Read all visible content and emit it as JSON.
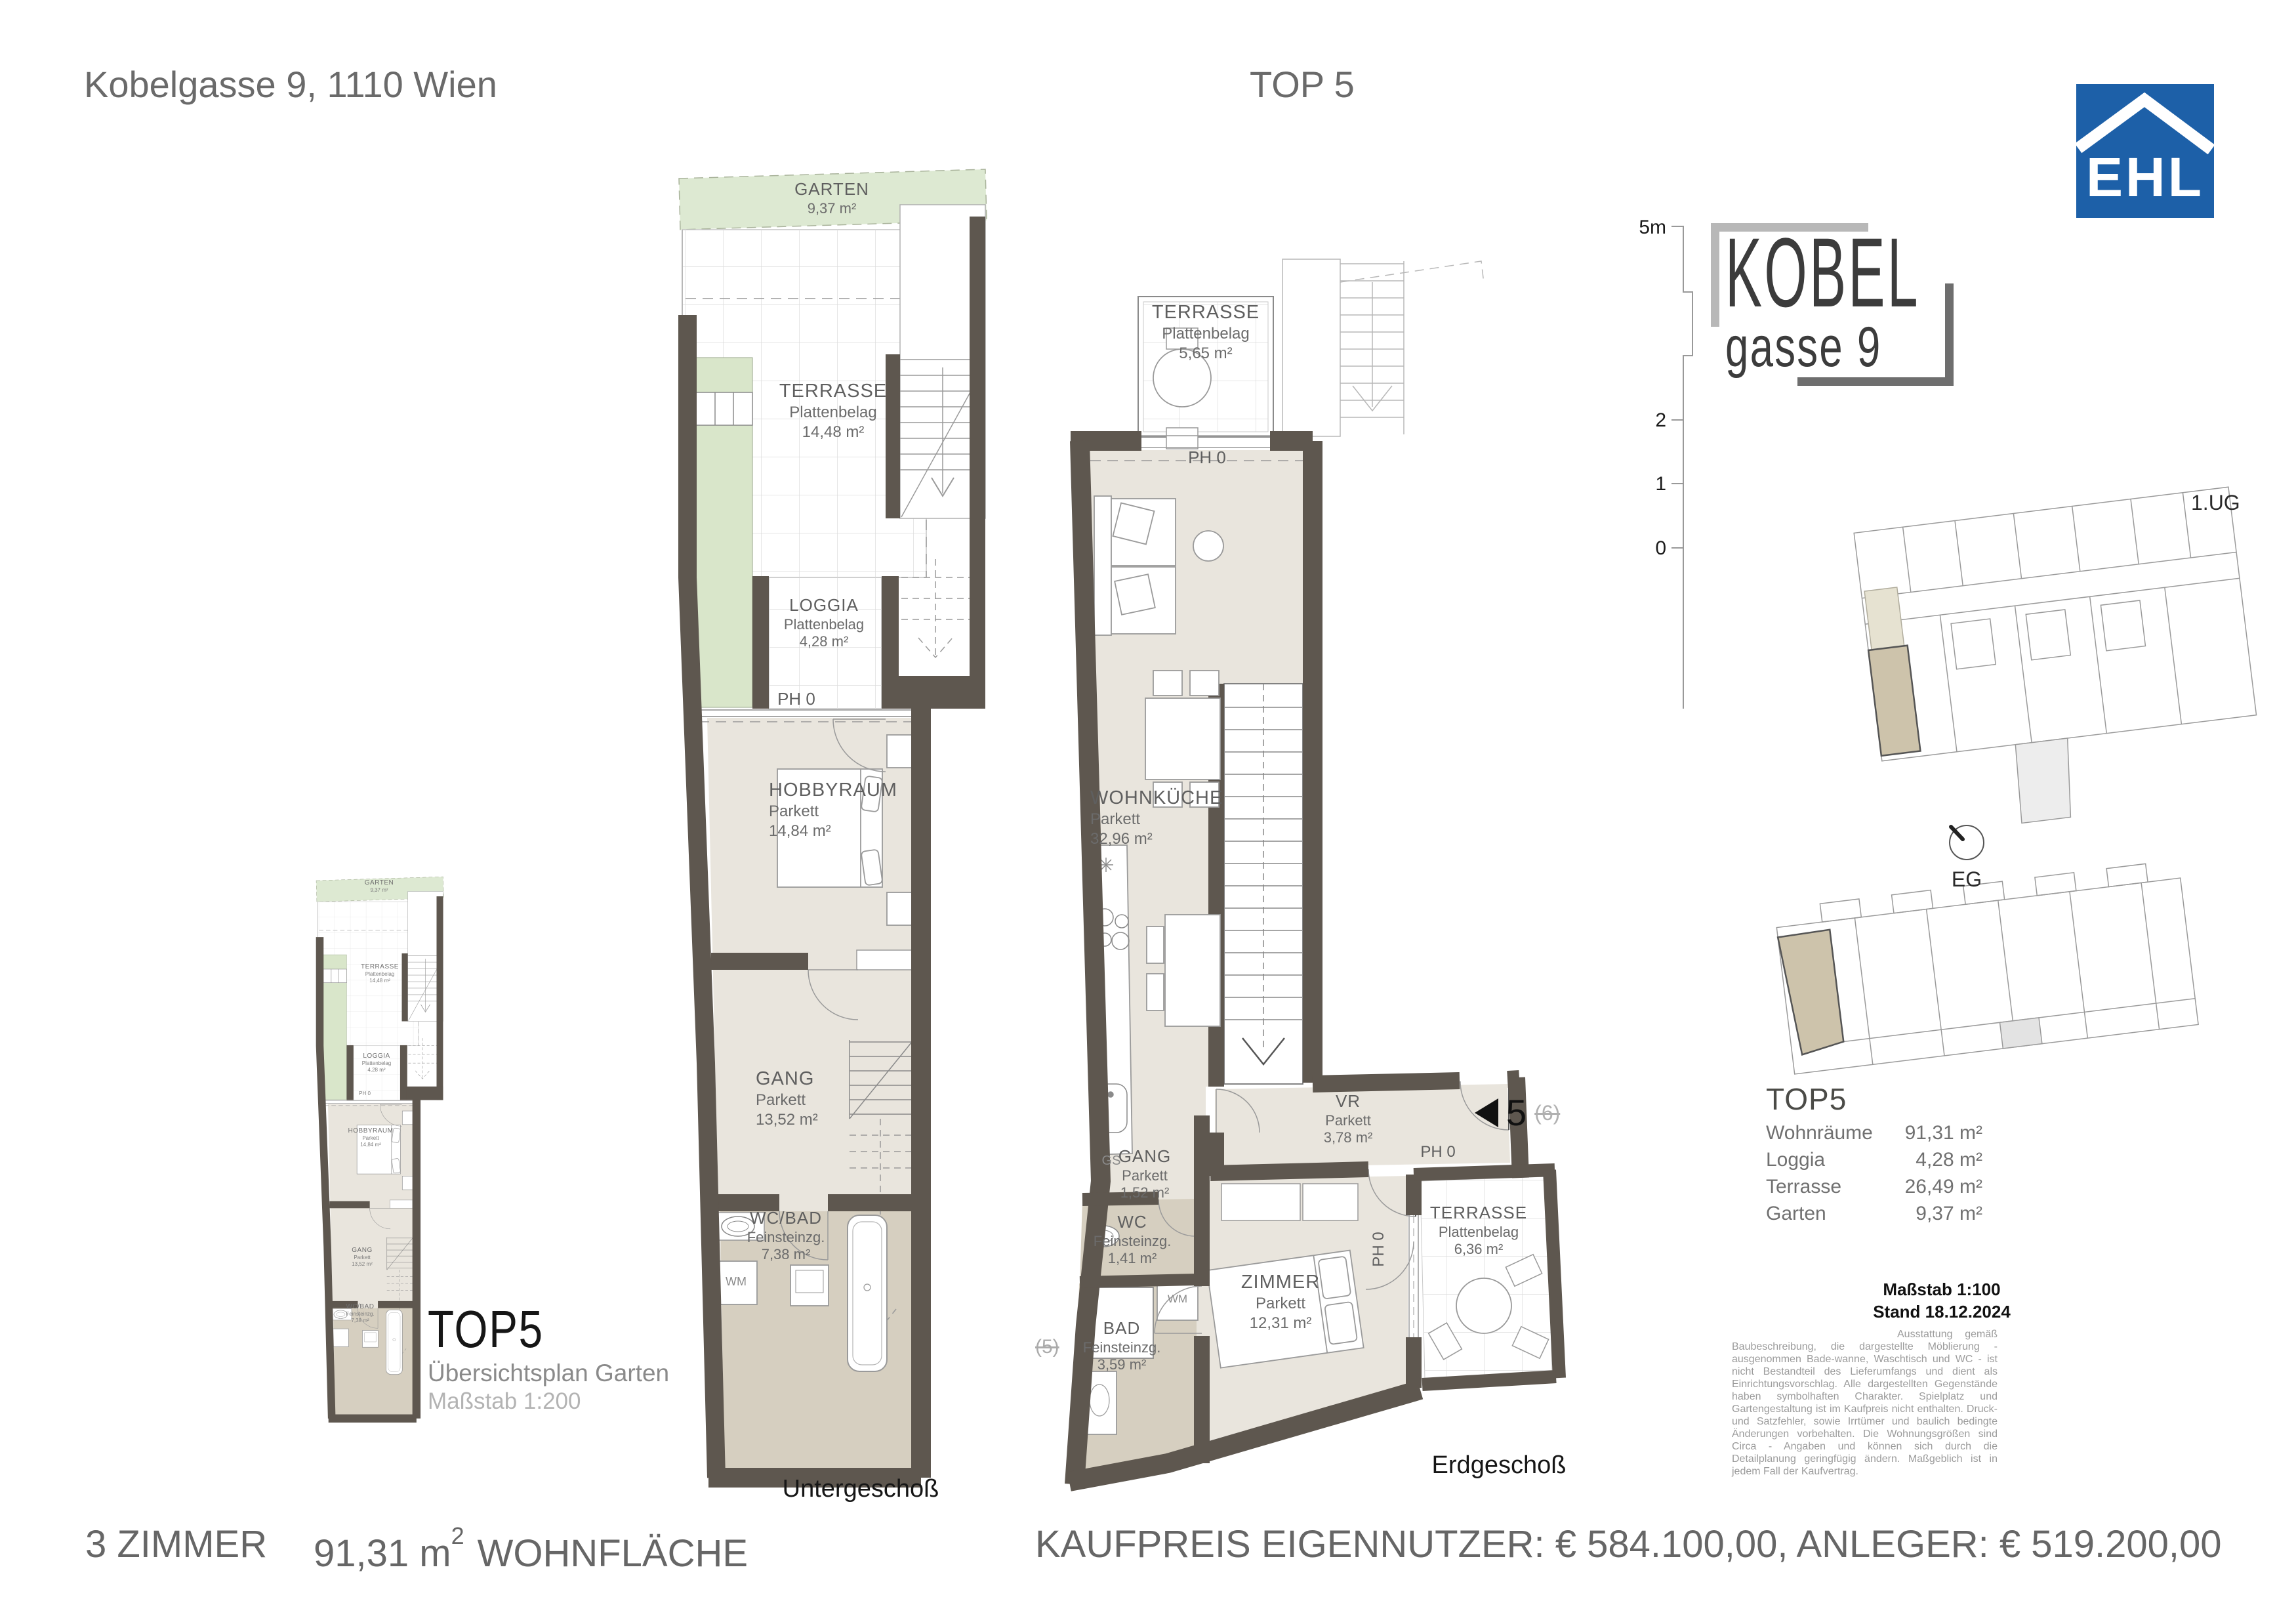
{
  "header": {
    "address": "Kobelgasse 9, 1110 Wien",
    "unit_title": "TOP 5"
  },
  "ehl_logo": {
    "text": "EHL",
    "blue": "#1d60a8"
  },
  "brand": {
    "line1": "KOBEL",
    "line2": "gasse 9"
  },
  "scale_bar": {
    "top": "5m",
    "mid": "2",
    "low": "1",
    "zero": "0"
  },
  "site_plans": {
    "upper": "1.UG",
    "lower": "EG"
  },
  "summary": {
    "title": "TOP5",
    "rows": [
      {
        "label": "Wohnräume",
        "value": "91,31 m²"
      },
      {
        "label": "Loggia",
        "value": "4,28 m²"
      },
      {
        "label": "Terrasse",
        "value": "26,49 m²"
      },
      {
        "label": "Garten",
        "value": "9,37 m²"
      }
    ],
    "scale": "Maßstab 1:100",
    "date": "Stand 18.12.2024",
    "disclaimer": "Ausstattung gemäß Baubeschreibung, die dargestellte Möblierung - ausgenommen Bade-wanne, Waschtisch und WC - ist nicht Bestandteil des Lieferumfangs und dient als Einrichtungsvorschlag. Alle dargestellten Gegenstände haben symbolhaften Charakter. Spielplatz und Gartengestaltung ist im Kaufpreis nicht enthalten. Druck- und Satzfehler, sowie Irrtümer und baulich bedingte Änderungen vorbehalten. Die Wohnungsgrößen sind Circa - Angaben und können sich durch die Detailplanung geringfügig ändern. Maßgeblich ist in jedem Fall der Kaufvertrag."
  },
  "basement": {
    "caption": "Untergeschoß",
    "garten": {
      "name": "GARTEN",
      "area": "9,37 m²"
    },
    "terrasse": {
      "name": "TERRASSE",
      "finish": "Plattenbelag",
      "area": "14,48 m²"
    },
    "loggia": {
      "name": "LOGGIA",
      "finish": "Plattenbelag",
      "area": "4,28 m²"
    },
    "ph0": "PH 0",
    "hobbyraum": {
      "name": "HOBBYRAUM",
      "finish": "Parkett",
      "area": "14,84 m²"
    },
    "gang": {
      "name": "GANG",
      "finish": "Parkett",
      "area": "13,52 m²"
    },
    "wcbad": {
      "name": "WC/BAD",
      "finish": "Feinsteinzg.",
      "area": "7,38 m²"
    },
    "wm": "WM"
  },
  "ground": {
    "caption": "Erdgeschoß",
    "terrasse_top": {
      "name": "TERRASSE",
      "finish": "Plattenbelag",
      "area": "5,65 m²"
    },
    "ph0_top": "PH 0",
    "wohnkueche": {
      "name": "WOHNKÜCHE",
      "finish": "Parkett",
      "area": "32,96 m²"
    },
    "gs": "GS",
    "vr": {
      "name": "VR",
      "finish": "Parkett",
      "area": "3,78 m²"
    },
    "ph0_entry": "PH 0",
    "ph0_terrace": "PH 0",
    "gang": {
      "name": "GANG",
      "finish": "Parkett",
      "area": "1,52 m²"
    },
    "wc": {
      "name": "WC",
      "finish": "Feinsteinzg.",
      "area": "1,41 m²"
    },
    "wm": "WM",
    "bad": {
      "name": "BAD",
      "finish": "Feinsteinzg.",
      "area": "3,59 m²"
    },
    "zimmer": {
      "name": "ZIMMER",
      "finish": "Parkett",
      "area": "12,31 m²"
    },
    "terrasse_bottom": {
      "name": "TERRASSE",
      "finish": "Plattenbelag",
      "area": "6,36 m²"
    },
    "unit_marker": "5",
    "unit_marker_old": "(6)",
    "side_marker": "(5)"
  },
  "overview": {
    "title": "TOP5",
    "subtitle": "Übersichtsplan Garten",
    "scale": "Maßstab 1:200"
  },
  "footer": {
    "rooms": "3 ZIMMER",
    "area_value": "91,31 m",
    "area_sup": "2",
    "area_label": "WOHNFLÄCHE",
    "price_line": "KAUFPREIS EIGENNUTZER: € 584.100,00, ANLEGER: € 519.200,00"
  }
}
